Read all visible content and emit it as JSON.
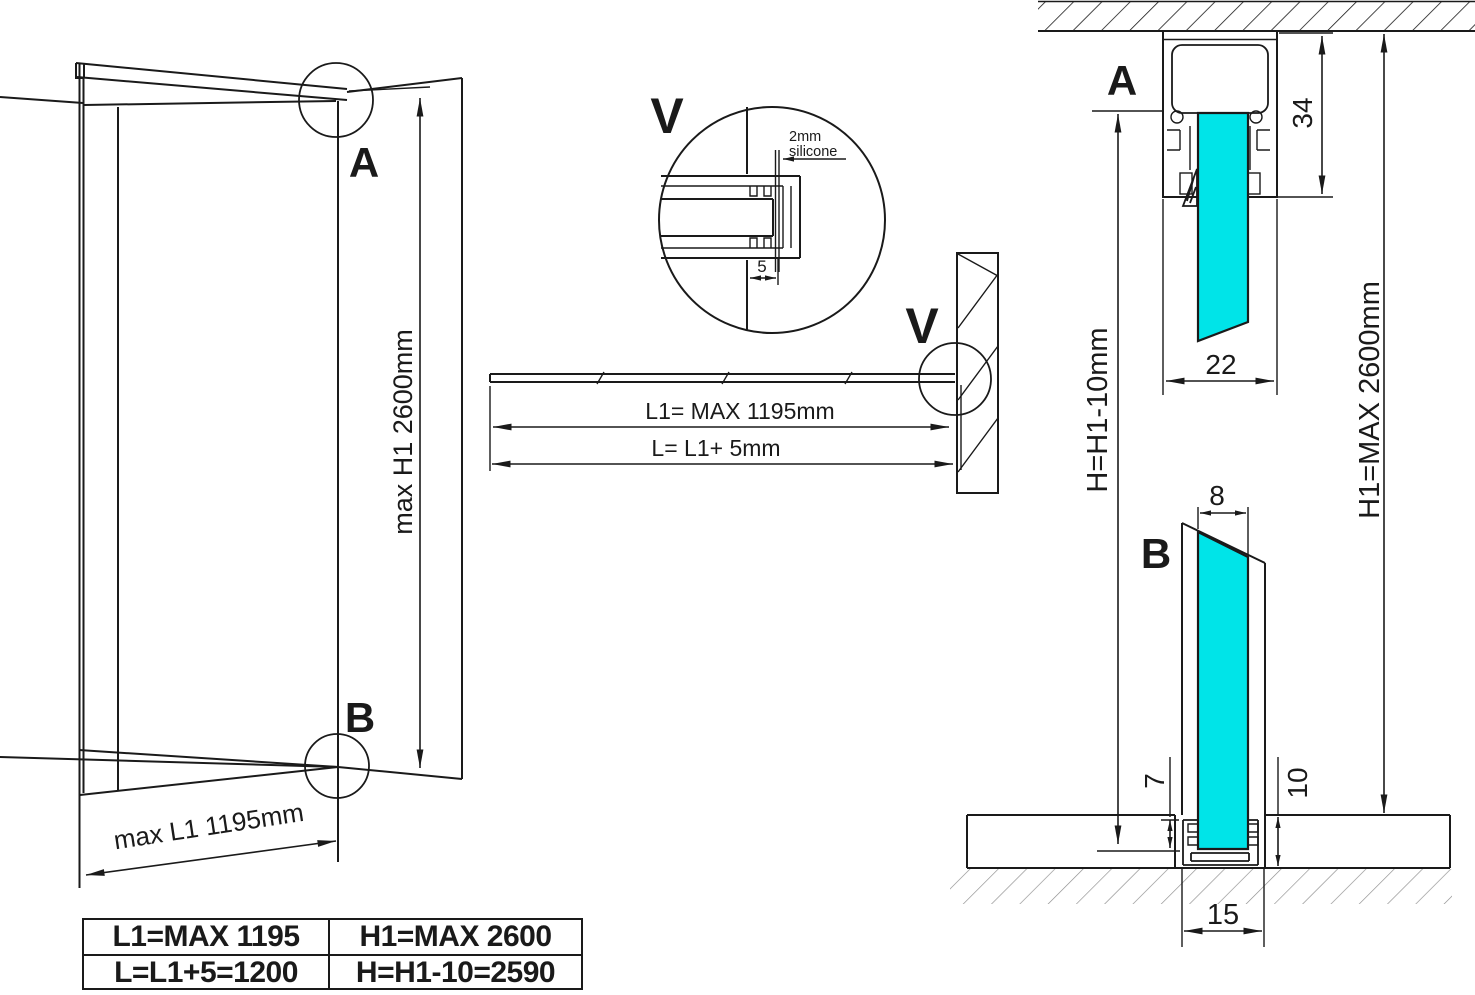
{
  "colors": {
    "ink": "#1a1a1a",
    "glass_fill": "#00e4e8"
  },
  "perspective": {
    "detail_a_label": "A",
    "detail_b_label": "B",
    "height_dim": "max H1 2600mm",
    "width_dim": "max L1 1195mm"
  },
  "detail_v": {
    "title": "V",
    "note_line1": "2mm",
    "note_line2": "silicone",
    "gap_dim": "5"
  },
  "plan": {
    "detail_v_label": "V",
    "glass_length_dim": "L1= MAX 1195mm",
    "cut_length_dim": "L= L1+ 5mm"
  },
  "section_a": {
    "label": "A",
    "profile_height_dim": "34",
    "profile_width_dim": "22"
  },
  "section_b": {
    "label": "B",
    "glass_thickness_dim": "8",
    "glass_seat_dim": "7",
    "profile_depth_dim": "10",
    "channel_width_dim": "15"
  },
  "heights": {
    "installed_height_dim": "H=H1-10mm",
    "max_height_dim": "H1=MAX 2600mm"
  },
  "spec_table": {
    "rows": [
      {
        "left": "L1=MAX 1195",
        "right": "H1=MAX 2600"
      },
      {
        "left": "L=L1+5=1200",
        "right": "H=H1-10=2590"
      }
    ]
  }
}
